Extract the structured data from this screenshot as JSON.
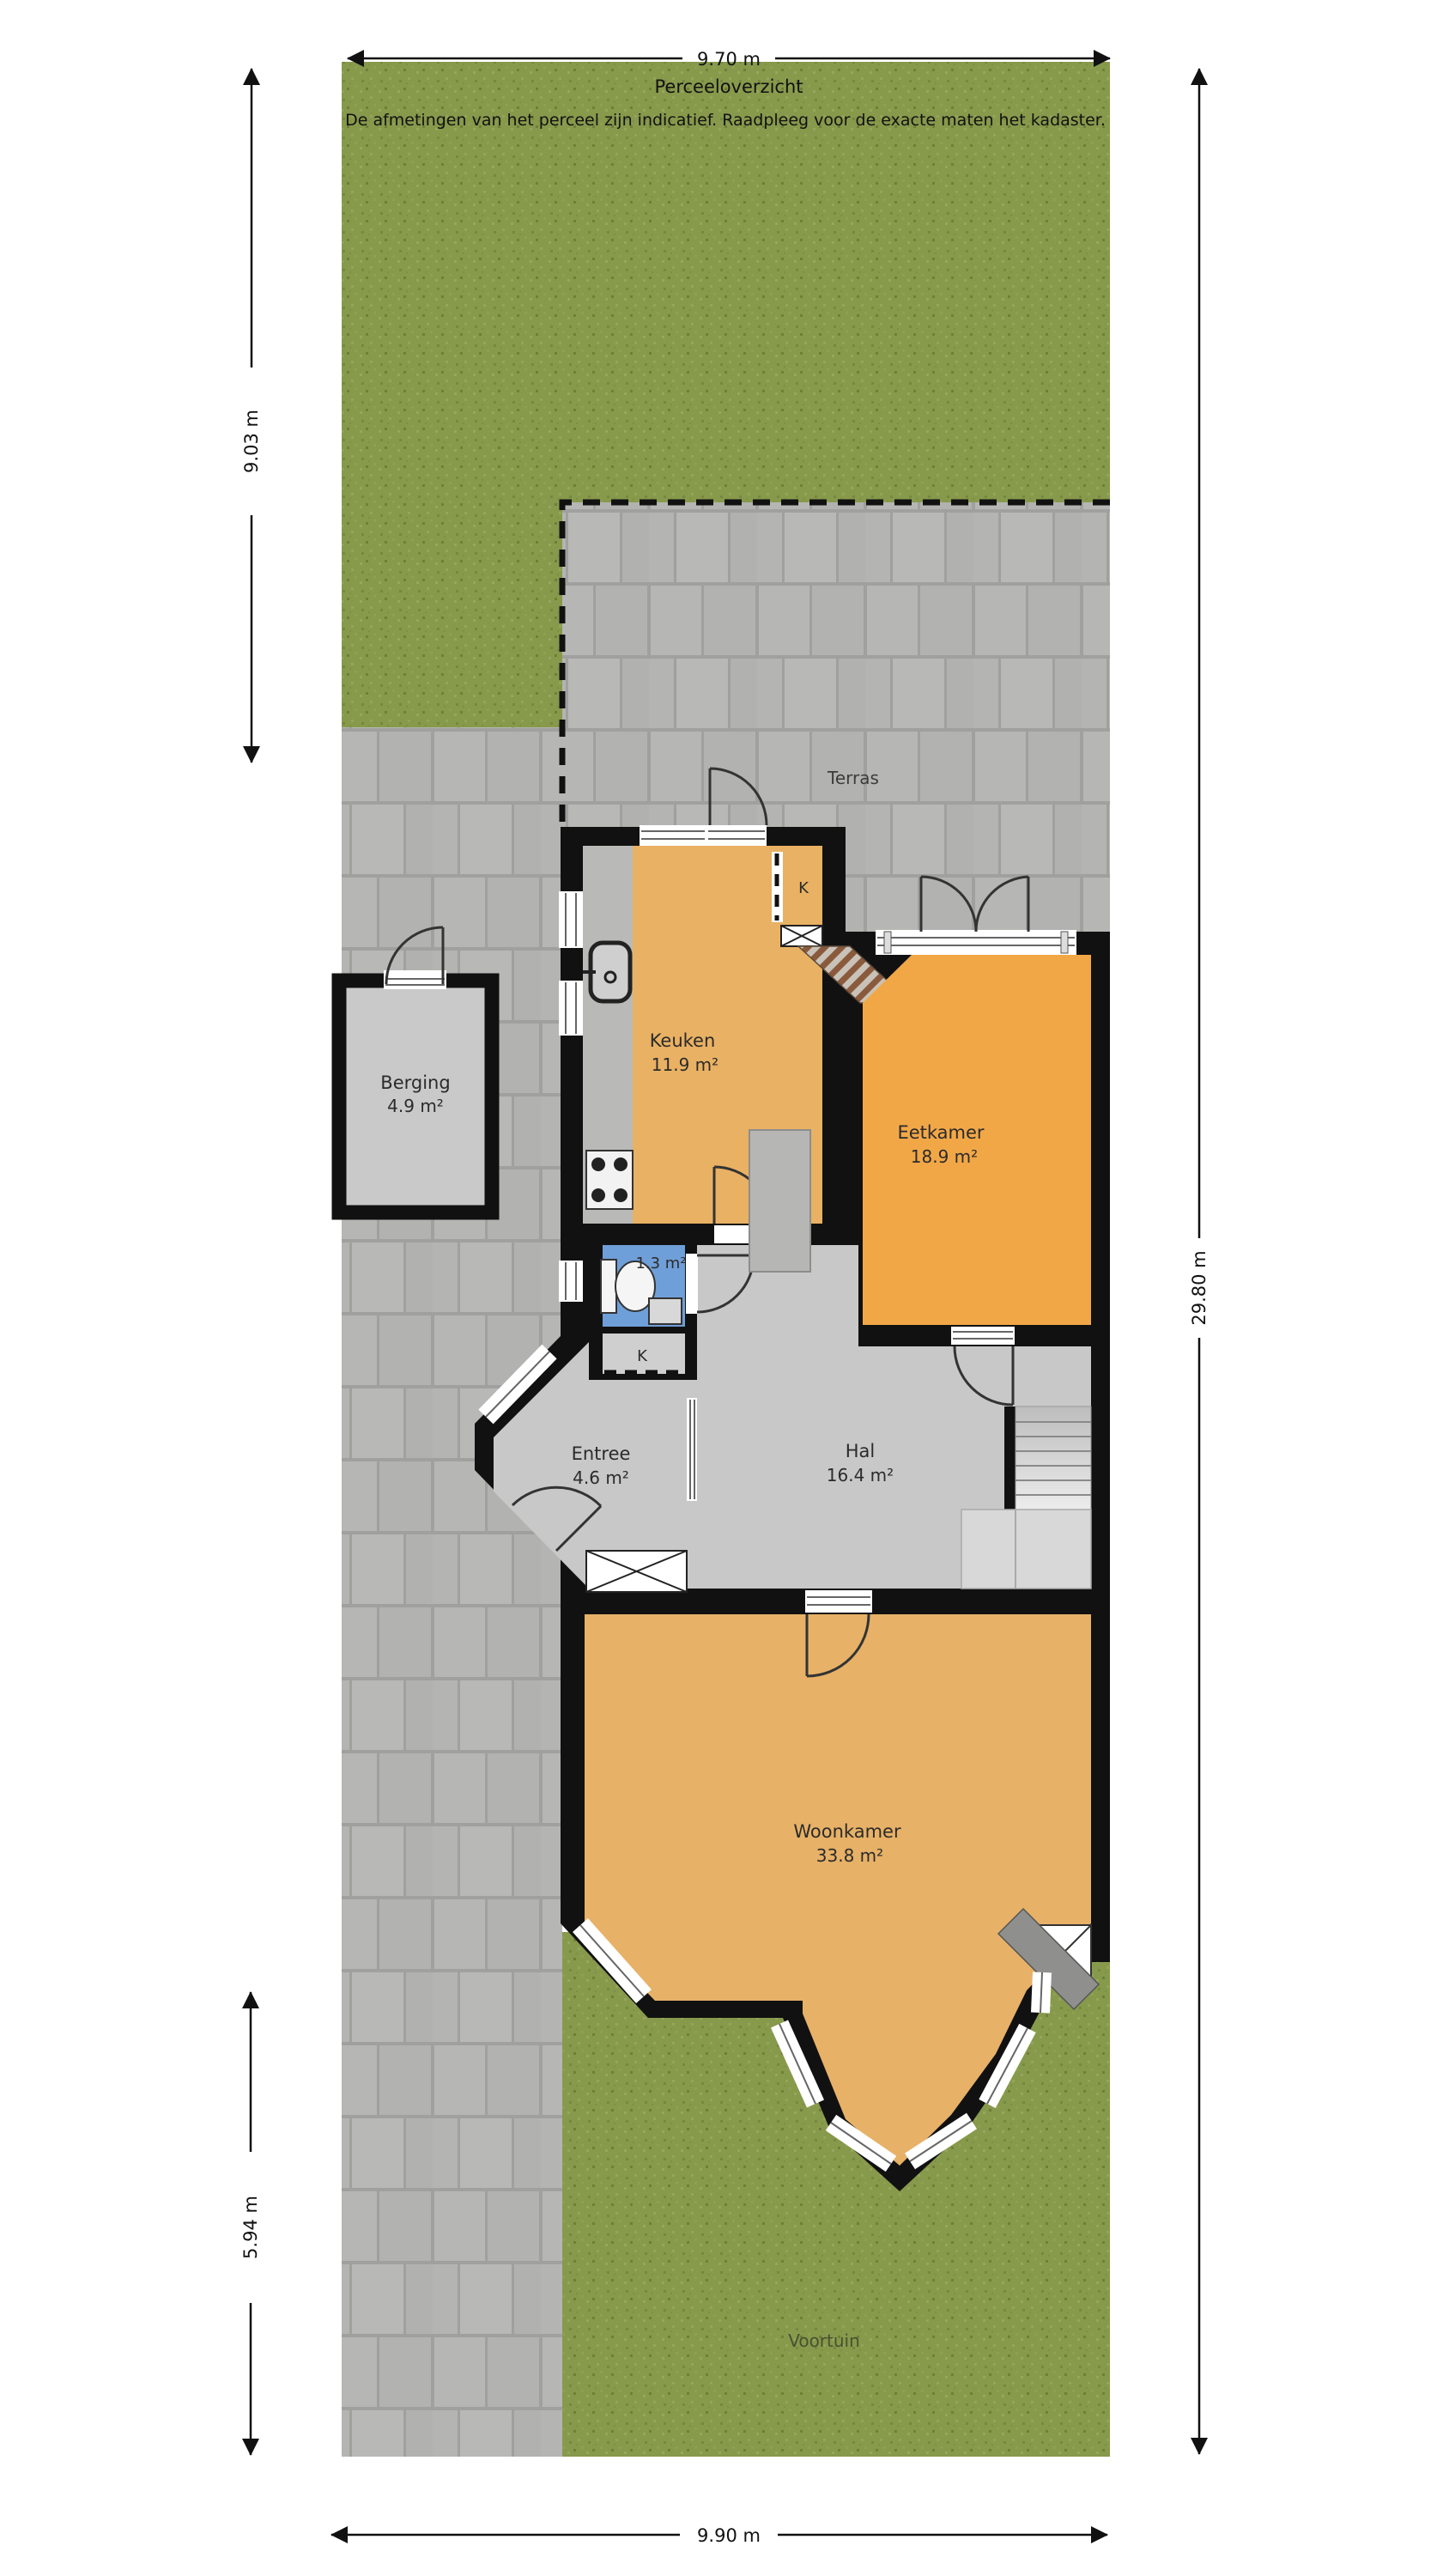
{
  "title": {
    "plan_label": "Perceeloverzicht",
    "disclaimer": "De afmetingen van het perceel zijn indicatief. Raadpleeg voor de exacte maten het kadaster."
  },
  "dimensions": {
    "top": "9.70 m",
    "left_upper": "9.03 m",
    "right": "29.80 m",
    "left_lower": "5.94 m",
    "bottom": "9.90 m"
  },
  "outdoor": {
    "terras": "Terras",
    "voortuin": "Voortuin"
  },
  "rooms": {
    "berging": {
      "name": "Berging",
      "area": "4.9 m²"
    },
    "keuken": {
      "name": "Keuken",
      "area": "11.9 m²"
    },
    "eetkamer": {
      "name": "Eetkamer",
      "area": "18.9 m²"
    },
    "toilet": {
      "area": "1.3 m²"
    },
    "entree": {
      "name": "Entree",
      "area": "4.6 m²"
    },
    "hal": {
      "name": "Hal",
      "area": "16.4 m²"
    },
    "woonkamer": {
      "name": "Woonkamer",
      "area": "33.8 m²"
    }
  },
  "closets": {
    "k1": "K",
    "k2": "K"
  },
  "colors": {
    "grass": "#87994b",
    "paver": "#b5b5b3",
    "wall": "#111111",
    "floor_orange": "#e9b163",
    "floor_orange_bright": "#f2a747",
    "floor_gray": "#c8c8c8",
    "toilet_blue": "#6f9fd8",
    "berging_gray": "#c9c9c9"
  }
}
